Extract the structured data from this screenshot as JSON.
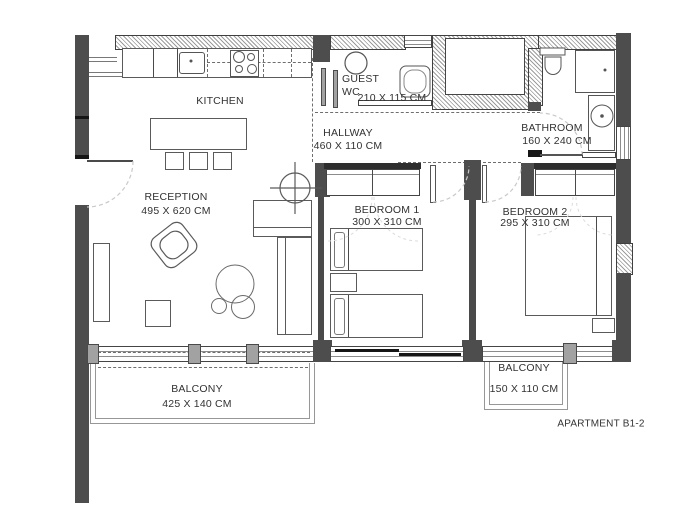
{
  "title": "APARTMENT B1-2",
  "rooms": {
    "kitchen": {
      "name": "KITCHEN"
    },
    "reception": {
      "name": "RECEPTION",
      "dims": "495 X 620 CM"
    },
    "guest_wc": {
      "line1": "GUEST",
      "line2": "WC",
      "dims": "210 X 115 CM"
    },
    "hallway": {
      "name": "HALLWAY",
      "dims": "460 X 110 CM"
    },
    "bathroom": {
      "name": "BATHROOM",
      "dims": "160 X 240 CM"
    },
    "bedroom1": {
      "name": "BEDROOM 1",
      "dims": "300 X 310 CM"
    },
    "bedroom2": {
      "name": "BEDROOM 2",
      "dims": "295 X 310 CM"
    },
    "balcony_left": {
      "name": "BALCONY",
      "dims": "425 X 140 CM"
    },
    "balcony_right": {
      "name": "BALCONY",
      "dims": "150 X 110 CM"
    }
  },
  "colors": {
    "wall_dark": "#4d4d4d",
    "hatch_line": "#9c9c9c",
    "outline": "#5a5a5a",
    "window_gray": "#a2a2a2",
    "text": "#323232"
  }
}
